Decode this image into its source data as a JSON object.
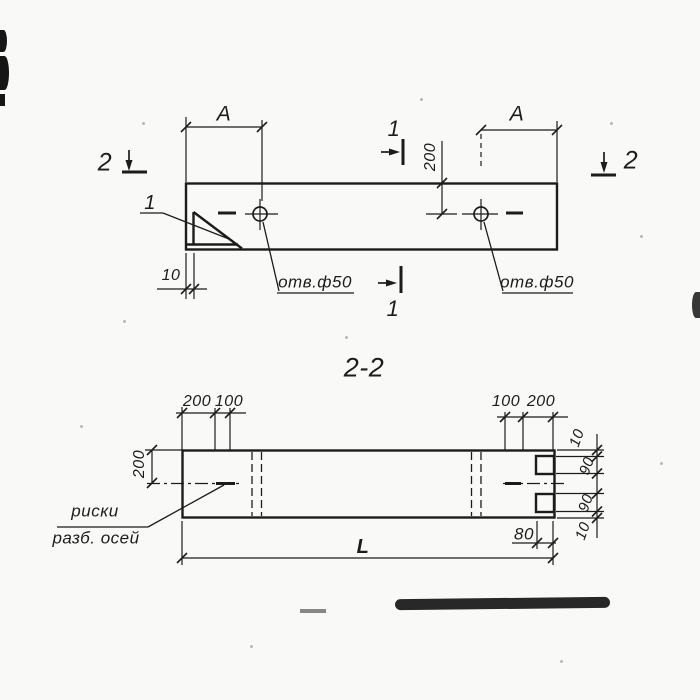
{
  "colors": {
    "ink": "#1c1c1c",
    "paper": "#f9f9f7"
  },
  "plan": {
    "dim_a_left": "A",
    "dim_a_right": "A",
    "dim_200": "200",
    "dim_10": "10",
    "hole_label_left": "отв.ф50",
    "hole_label_right": "отв.ф50",
    "detail_label": "1",
    "section_mark_2_left": "2",
    "section_mark_2_right": "2",
    "section_mark_1_top": "1",
    "section_mark_1_bottom": "1"
  },
  "section": {
    "title": "2-2",
    "dim_top_left_200": "200",
    "dim_top_left_100": "100",
    "dim_top_right_100": "100",
    "dim_top_right_200": "200",
    "dim_left_200": "200",
    "chain_top_10": "10",
    "chain_top_90": "90",
    "chain_bottom_90": "90",
    "chain_bottom_10": "10",
    "dim_80": "80",
    "dim_length": "L",
    "note_line1": "риски",
    "note_line2": "разб. осей"
  }
}
